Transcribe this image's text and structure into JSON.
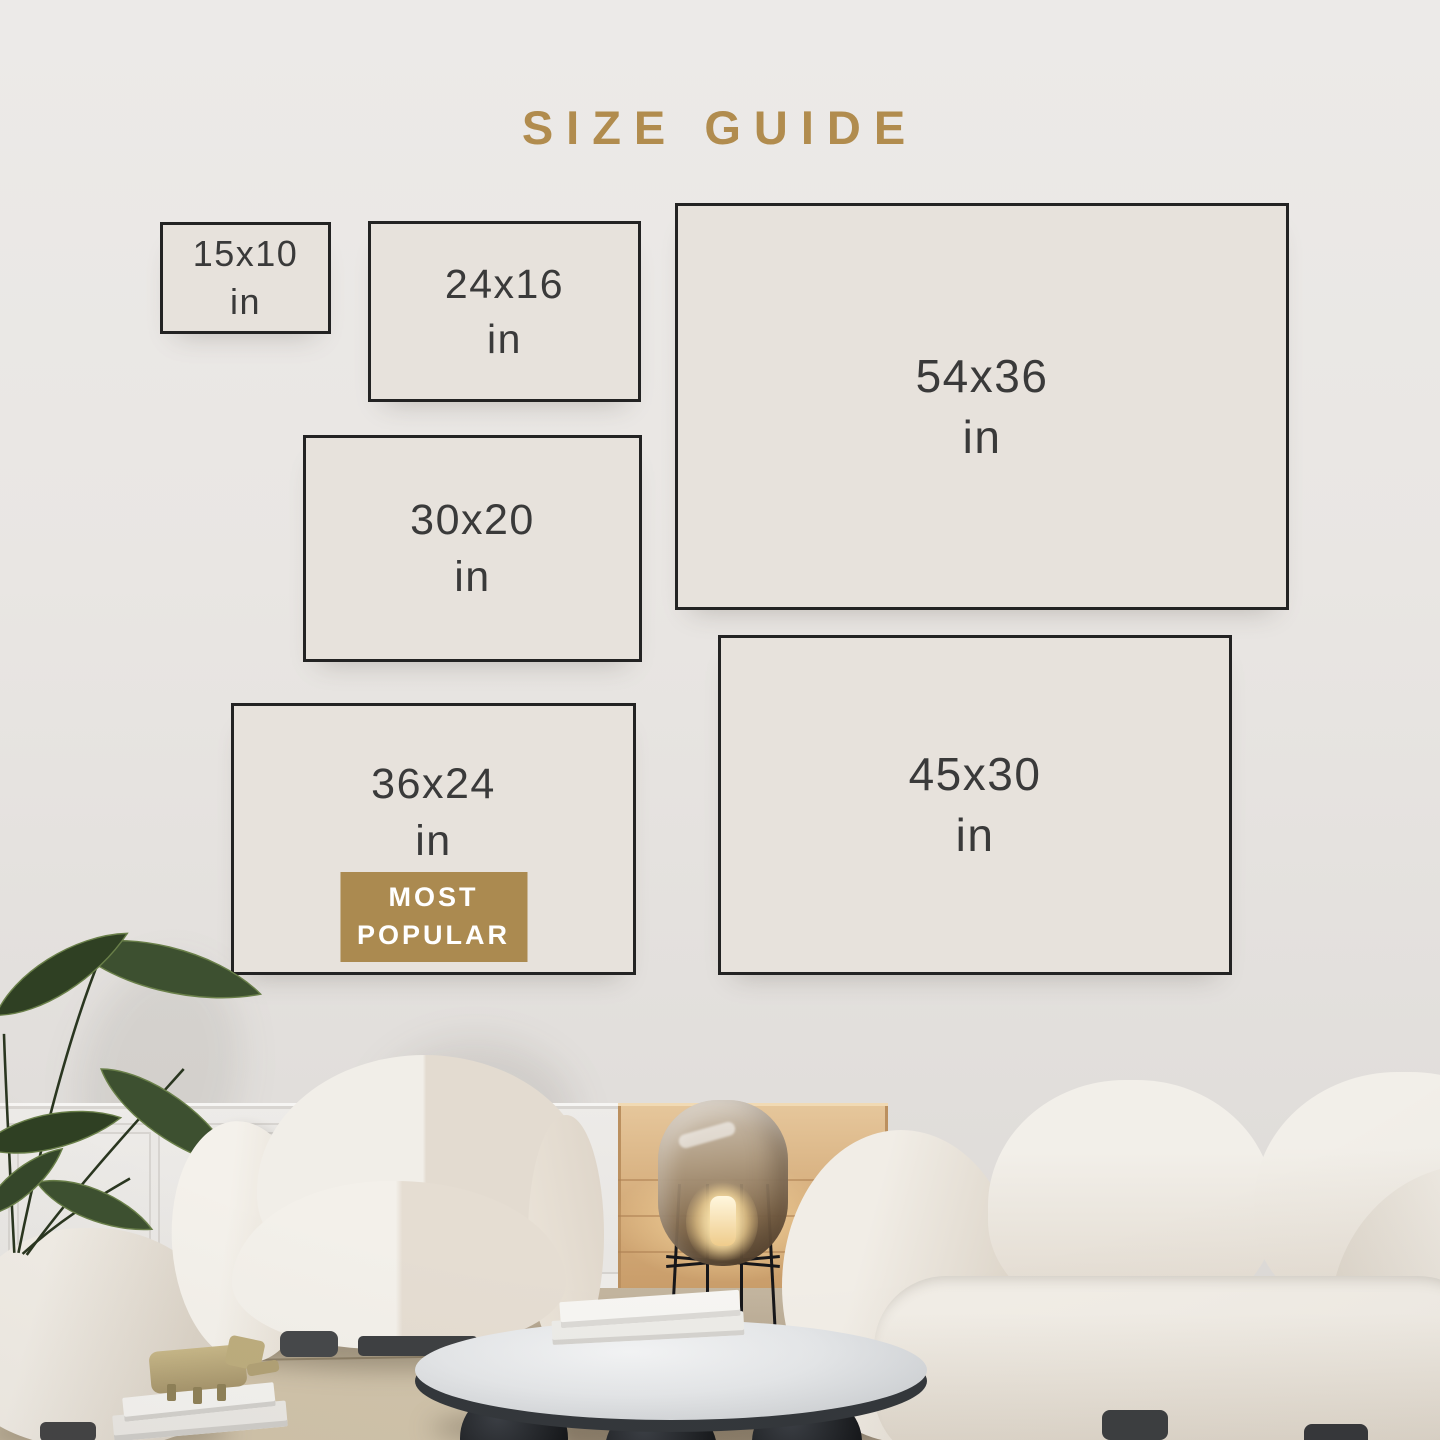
{
  "page": {
    "title": "SIZE GUIDE"
  },
  "colors": {
    "accent_gold": "#b18c4e",
    "badge_gold": "#ab8a50",
    "frame_border": "#232323",
    "frame_fill": "#e7e2dc",
    "label_text": "#3a3a3a"
  },
  "size_guide": {
    "sizes": [
      {
        "label": "15x10",
        "unit": "in",
        "most_popular": false
      },
      {
        "label": "24x16",
        "unit": "in",
        "most_popular": false
      },
      {
        "label": "54x36",
        "unit": "in",
        "most_popular": false
      },
      {
        "label": "30x20",
        "unit": "in",
        "most_popular": false
      },
      {
        "label": "36x24",
        "unit": "in",
        "most_popular": true
      },
      {
        "label": "45x30",
        "unit": "in",
        "most_popular": false
      }
    ],
    "most_popular_badge": {
      "line1": "MOST",
      "line2": "POPULAR"
    }
  }
}
